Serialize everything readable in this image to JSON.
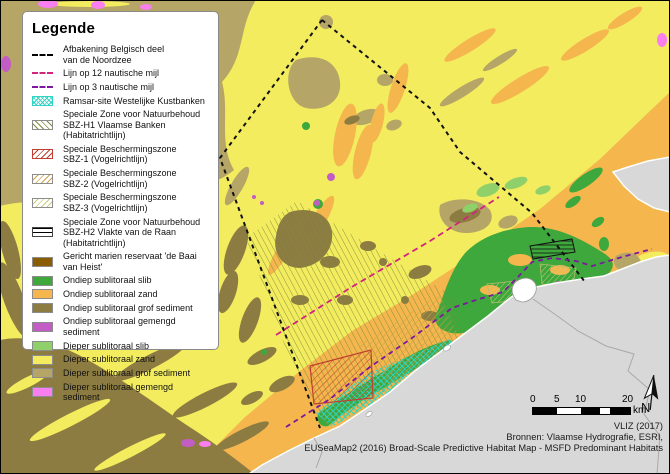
{
  "legend": {
    "title": "Legende",
    "items": [
      {
        "label": "Afbakening Belgisch deel\nvan de Noordzee",
        "symbol": "black-dashed-line"
      },
      {
        "label": "Lijn op 12 nautische mijl",
        "symbol": "magenta-dashed-line"
      },
      {
        "label": "Lijn op 3 nautische mijl",
        "symbol": "purple-dashed-line"
      },
      {
        "label": "Ramsar-site Westelijke Kustbanken",
        "symbol": "cyan-crosshatch"
      },
      {
        "label": "Speciale Zone voor Natuurbehoud\nSBZ-H1 Vlaamse Banken (Habitatrichtlijn)",
        "symbol": "olive-hatch"
      },
      {
        "label": "Speciale Beschermingszone\nSBZ-1 (Vogelrichtlijn)",
        "symbol": "red-hatch"
      },
      {
        "label": "Speciale Beschermingszone\nSBZ-2 (Vogelrichtlijn)",
        "symbol": "khaki-hatch"
      },
      {
        "label": "Speciale Beschermingszone\nSBZ-3 (Vogelrichtlijn)",
        "symbol": "pale-yellow-hatch"
      },
      {
        "label": "Speciale Zone voor Natuurbehoud\nSBZ-H2 Vlakte van de Raan (Habitatrichtlijn)",
        "symbol": "horizontal-lines"
      },
      {
        "label": "Gericht marien reservaat 'de Baai van Heist'",
        "symbol": "solid-brown"
      },
      {
        "label": "Ondiep sublitoraal slib",
        "symbol": "solid-green"
      },
      {
        "label": "Ondiep sublitoraal zand",
        "symbol": "solid-orange"
      },
      {
        "label": "Ondiep sublitoraal grof sediment",
        "symbol": "solid-olive"
      },
      {
        "label": "Ondiep sublitoraal gemengd sediment",
        "symbol": "solid-magenta"
      },
      {
        "label": "Dieper sublitoraal slib",
        "symbol": "solid-lightgreen"
      },
      {
        "label": "Dieper sublitoraal zand",
        "symbol": "solid-yellow"
      },
      {
        "label": "Dieper sublitoraal grof sediment",
        "symbol": "solid-tan"
      },
      {
        "label": "Dieper sublitoraal gemengd sediment",
        "symbol": "solid-pink"
      }
    ]
  },
  "scalebar": {
    "tick0": "0",
    "tick1": "5",
    "tick2": "10",
    "tick3": "20",
    "unit": "km"
  },
  "north_label": "N",
  "credits": {
    "line1": "VLIZ (2017)",
    "line2": "Bronnen: Vlaamse Hydrografie,  ESRI,",
    "line3": "EUSeaMap2 (2016) Broad-Scale Predictive Habitat Map - MSFD Predominant Habitats"
  },
  "palette": {
    "yellow": "#f2ec5e",
    "orange": "#f4b64d",
    "olive": "#8d7c41",
    "tan": "#b5a566",
    "green": "#3ea83c",
    "lgreen": "#90d06a",
    "magenta": "#c25dc6",
    "pink": "#f97ef0",
    "brown": "#8a5c04",
    "land": "#d8d8d8",
    "landline": "#a9a9a9",
    "coast": "#ffffff",
    "ramsar": "#2fd5c2",
    "sbzh1": "#7d8c3c",
    "sbz1": "#bf4030",
    "sbz2": "#c8a24b",
    "sbz3": "#c9cd7d",
    "eez": "#111111",
    "nm12": "#d2237e",
    "nm3": "#7c17a0"
  }
}
